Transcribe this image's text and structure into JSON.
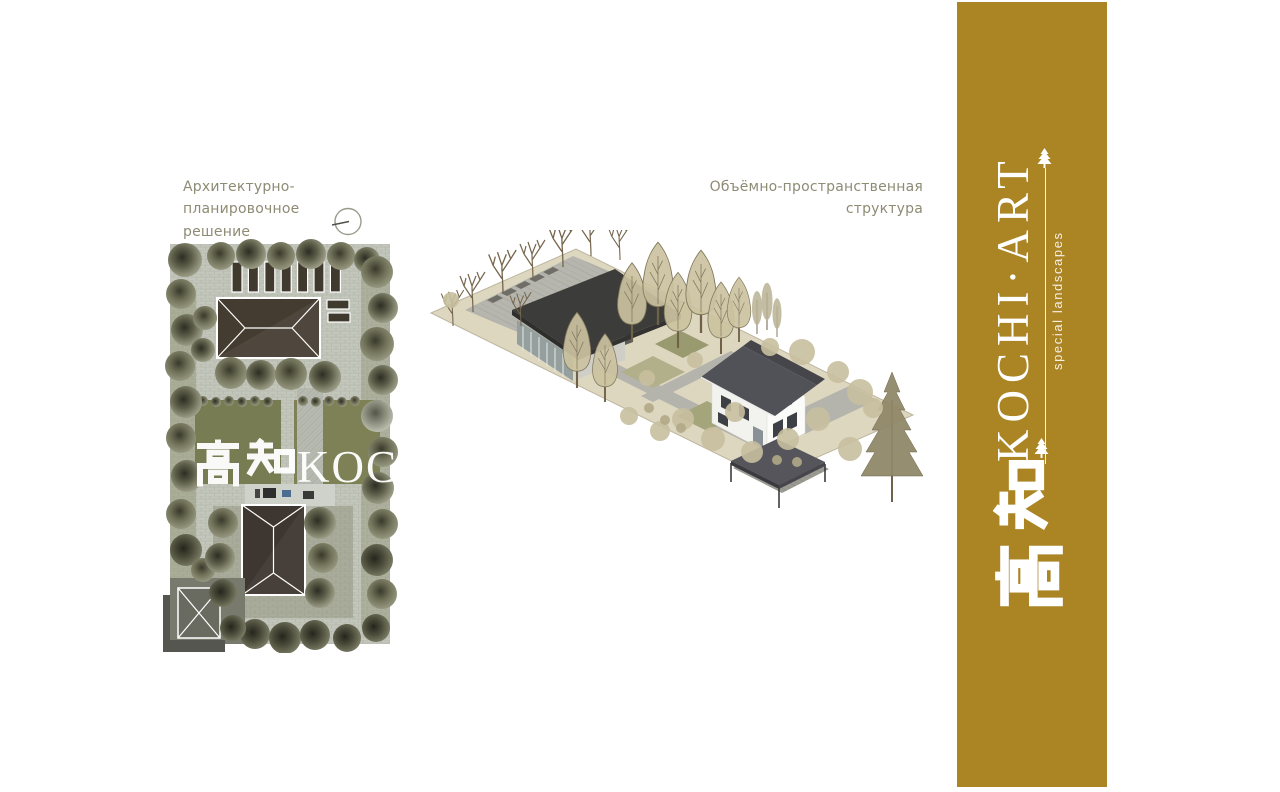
{
  "slide": {
    "plan_section": {
      "title_line1": "Архитектурно-планировочное",
      "title_line2": "решение"
    },
    "axon_section": {
      "title_line1": "Объёмно-пространственная",
      "title_line2": "структура"
    },
    "watermark": {
      "kanji": "高知",
      "latin": "KOCHI"
    },
    "banner": {
      "logo": "KOCHI·ART",
      "tagline": "special landscapes",
      "kanji": "高知",
      "background_color": "#AB8424",
      "text_color": "#FFFFFF"
    },
    "icons": {
      "north_indicator": "compass-circle",
      "pine": "pine-tree"
    },
    "colors": {
      "title_text": "#8E8B74",
      "banner_gold": "#AB8424",
      "roof_dark": "#433B31",
      "lawn_olive": "#7A7D53",
      "paving_gray": "#C3C6BB"
    }
  }
}
